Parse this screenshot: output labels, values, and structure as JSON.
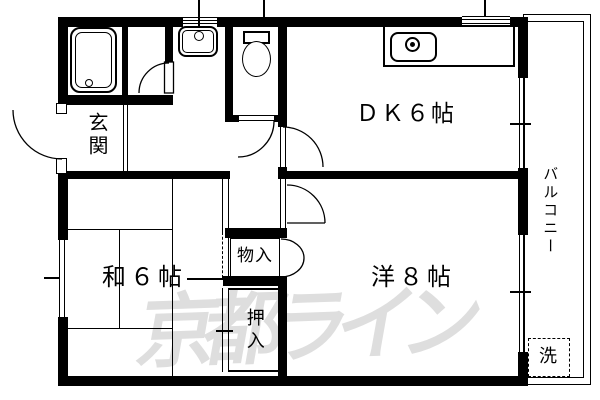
{
  "floorplan": {
    "watermark": "京都ライン",
    "rooms": {
      "dk": "ＤＫ６帖",
      "washitsu": "和６帖",
      "youshitsu": "洋８帖",
      "genkan": "玄関",
      "monoire": "物入",
      "oshiire": "押入",
      "balcony": "バルコニー",
      "laundry": "洗"
    },
    "colors": {
      "wall": "#000000",
      "background": "#ffffff",
      "watermark": "#dedede"
    }
  }
}
